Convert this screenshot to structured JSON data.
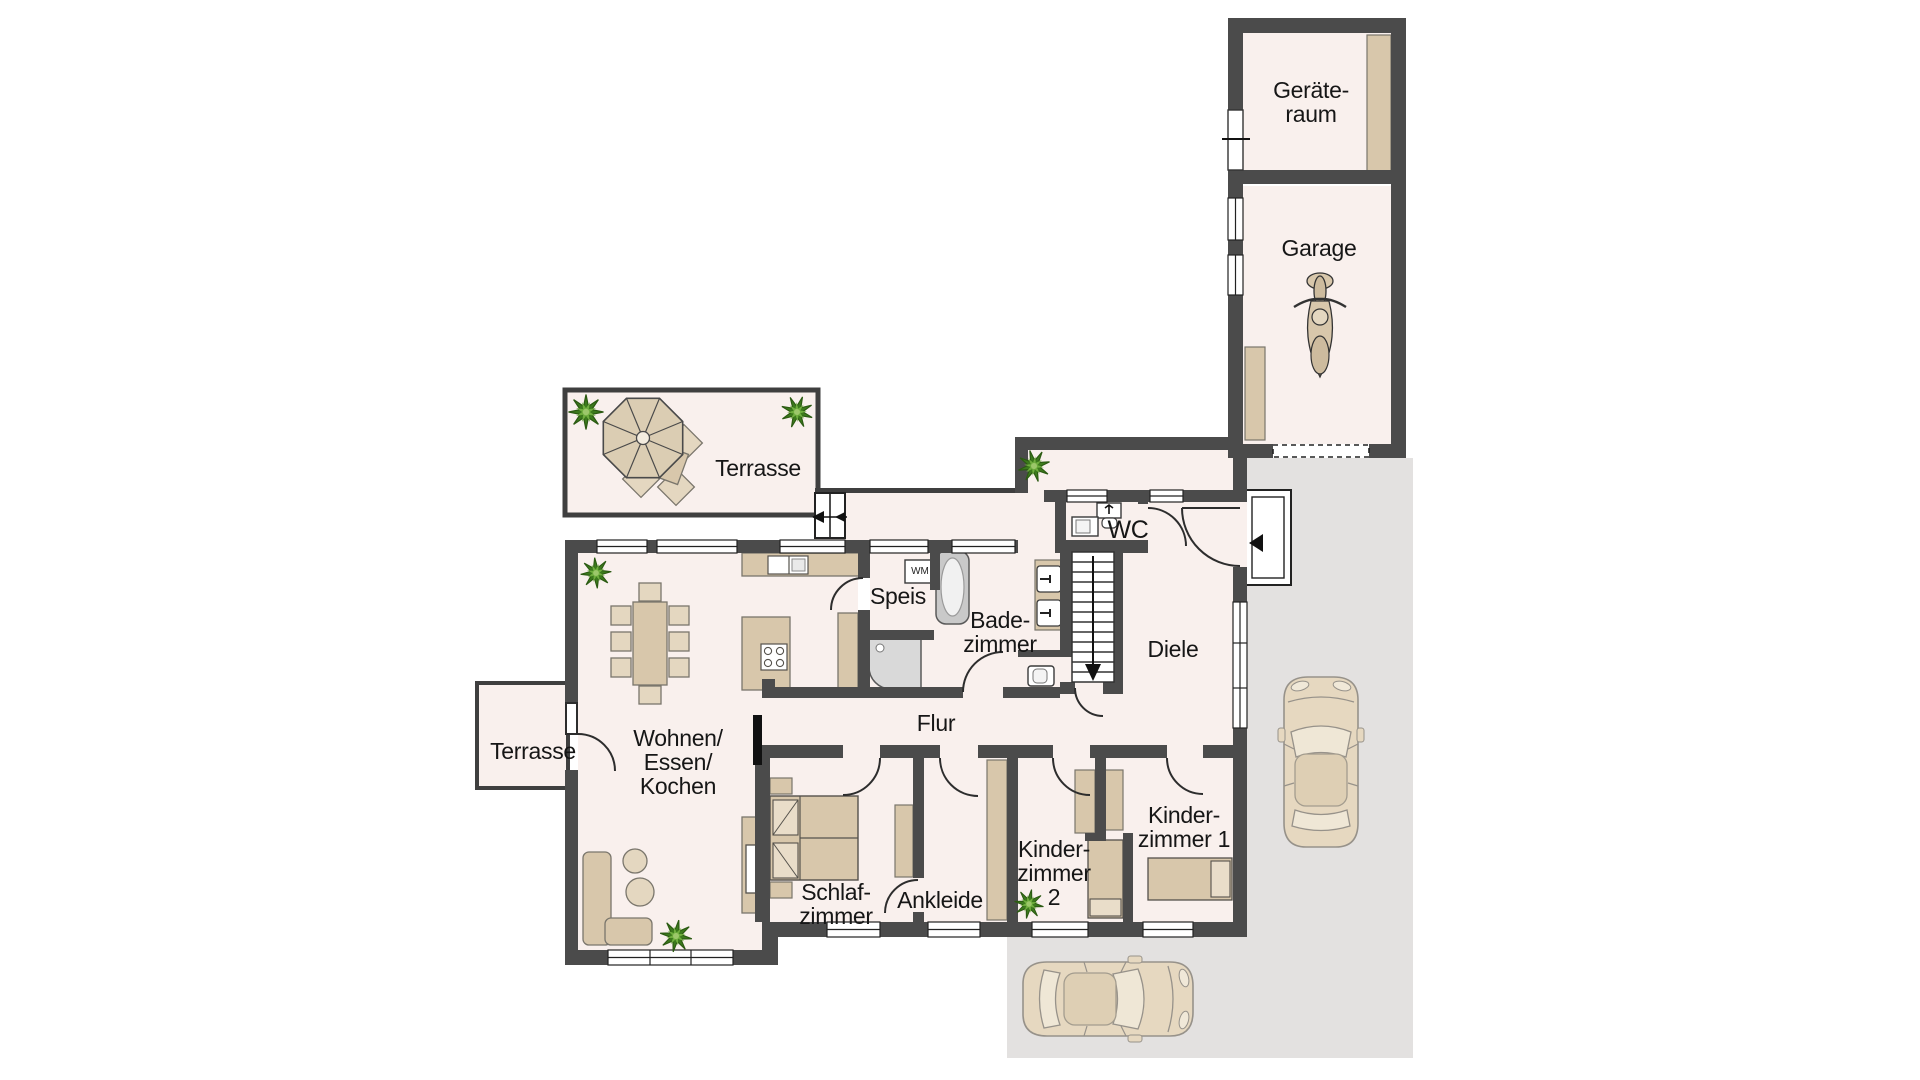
{
  "plan": {
    "rooms": {
      "geraeteraum": "Geräte-\nraum",
      "garage": "Garage",
      "terrasse_top": "Terrasse",
      "wc": "WC",
      "speis": "Speis",
      "badezimmer": "Bade-\nzimmer",
      "diele": "Diele",
      "flur": "Flur",
      "wohnen": "Wohnen/\nEssen/\nKochen",
      "terrasse_left": "Terrasse",
      "schlafzimmer": "Schlaf-\nzimmer",
      "ankleide": "Ankleide",
      "kinderzimmer2": "Kinder-\nzimmer\n2",
      "kinderzimmer1": "Kinder-\nzimmer 1"
    },
    "appliances": {
      "washing_machine": "WM"
    },
    "colors": {
      "wall": "#4b4b4b",
      "floor": "#f9f0ed",
      "furniture": "#d8c7ab",
      "furniture_light": "#e4d7c0",
      "driveway": "#e3e1e0",
      "plant_dark": "#3c7a1c",
      "plant_light": "#6fae3e",
      "car_body": "#e6d8c0"
    }
  }
}
